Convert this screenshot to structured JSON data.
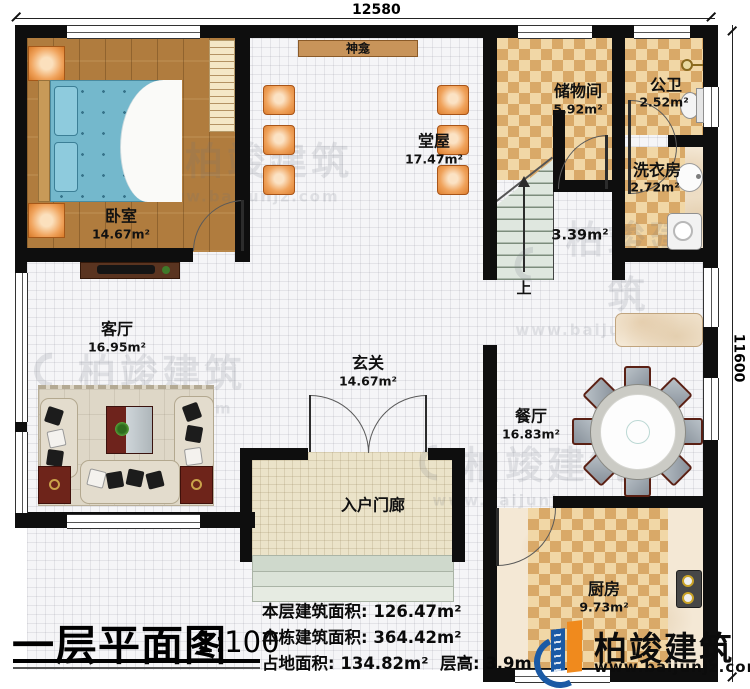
{
  "dimensions": {
    "top": "12580",
    "right": "11600"
  },
  "rooms": {
    "bedroom": {
      "name": "卧室",
      "area": "14.67m²"
    },
    "hall": {
      "name": "堂屋",
      "area": "17.47m²"
    },
    "shrine": {
      "name": "神龛"
    },
    "storage": {
      "name": "储物间",
      "area": "5.92m²"
    },
    "bath": {
      "name": "公卫",
      "area": "2.52m²"
    },
    "laundry": {
      "name": "洗衣房",
      "area": "2.72m²"
    },
    "stairwell": {
      "area": "3.39m²",
      "direction": "上"
    },
    "living": {
      "name": "客厅",
      "area": "16.95m²"
    },
    "foyer": {
      "name": "玄关",
      "area": "14.67m²"
    },
    "dining": {
      "name": "餐厅",
      "area": "16.83m²"
    },
    "kitchen": {
      "name": "厨房",
      "area": "9.73m²"
    },
    "porch": {
      "name": "入户门廊"
    }
  },
  "title": {
    "text": "一层平面图",
    "scale": "1:100"
  },
  "stats": {
    "line1_label": "本层建筑面积:",
    "line1_value": "126.47m²",
    "line2_label": "本栋建筑面积:",
    "line2_value": "364.42m²",
    "line3_label": "占地面积:",
    "line3_value": "134.82m²",
    "line3b_label": "层高:",
    "line3b_value": "3.9m"
  },
  "brand": {
    "name": "柏竣建筑",
    "url": "www.baijunjz.com"
  },
  "watermark": {
    "name": "柏竣建筑",
    "url": "www.baijunjz.com"
  },
  "colors": {
    "wall": "#0e0e0e",
    "wood": "#b07c3e",
    "checker_dark": "#d9a968",
    "checker_light": "#f1d7a6",
    "brand_blue": "#1b5aa5",
    "brand_orange": "#f08a1d"
  }
}
